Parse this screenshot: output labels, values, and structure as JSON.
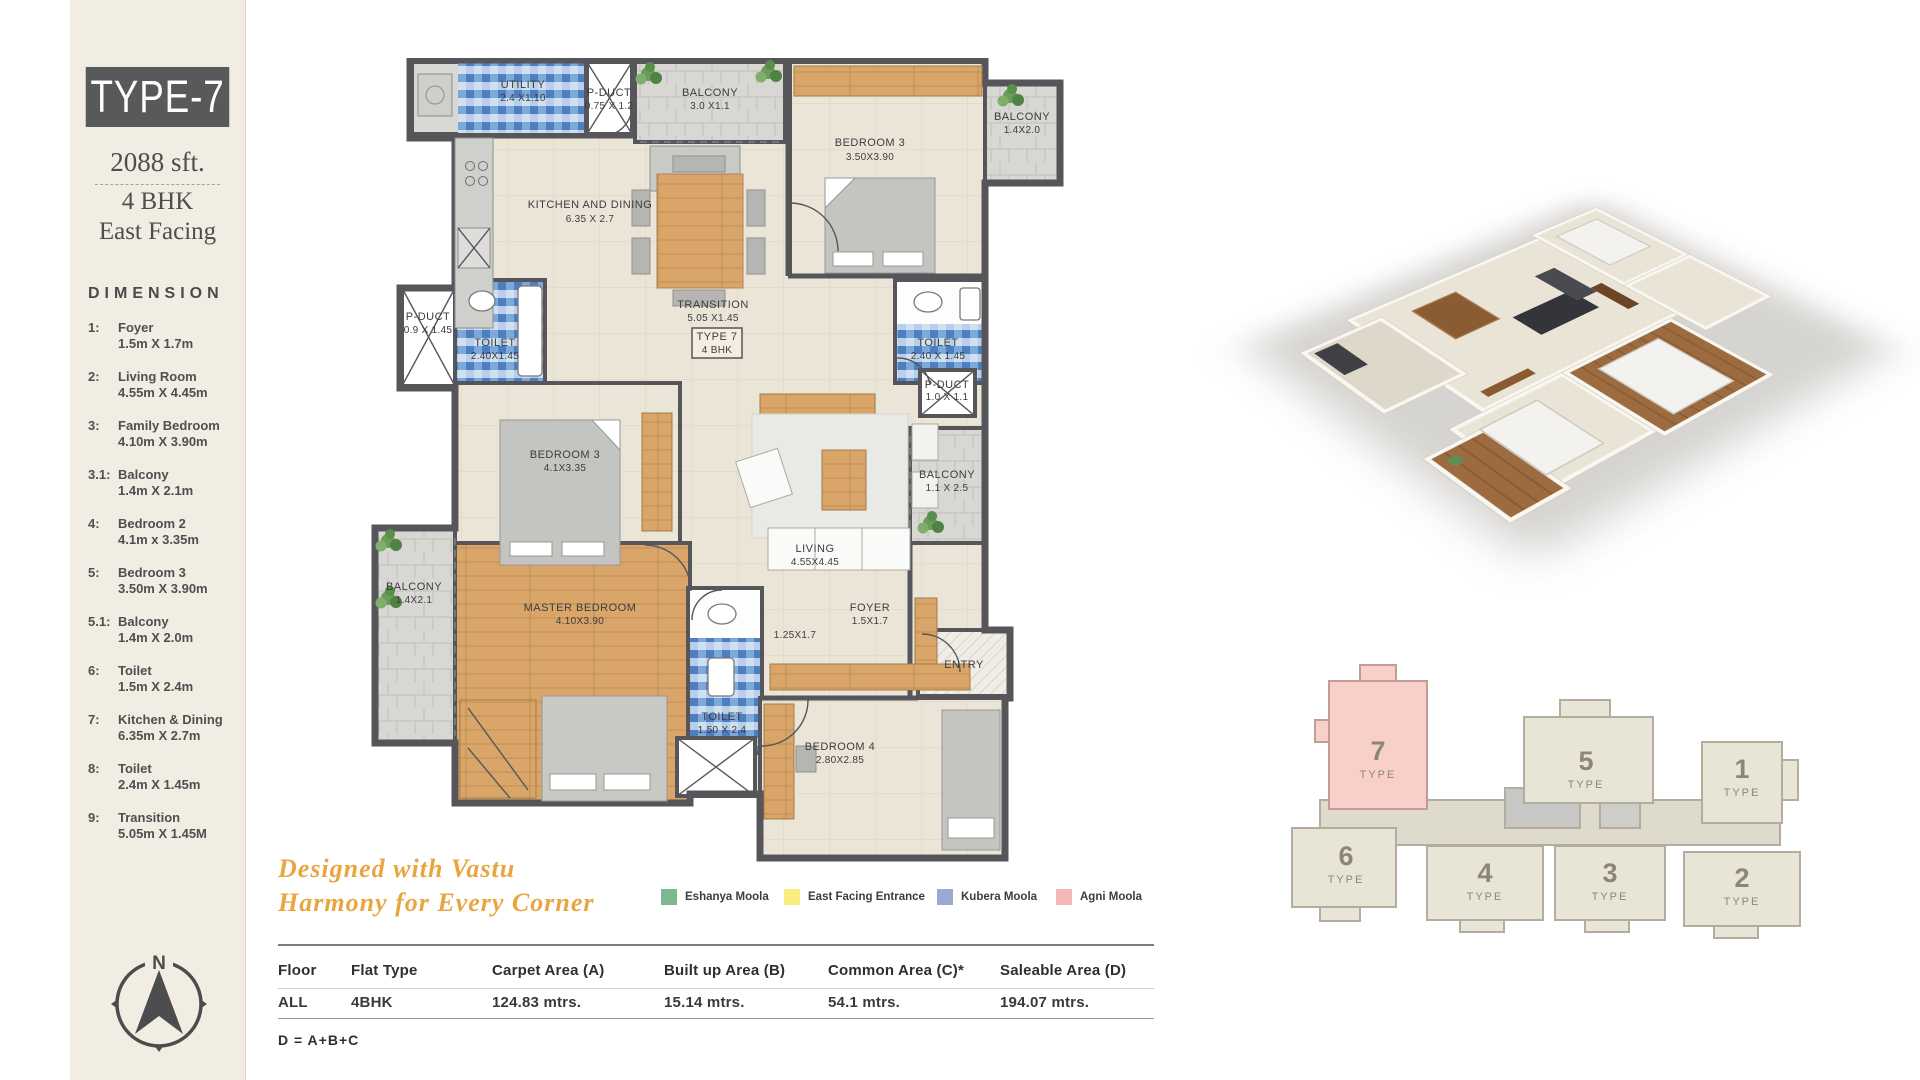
{
  "sidebar": {
    "type_label": "TYPE-7",
    "area": "2088 sft.",
    "bhk": "4 BHK",
    "facing": "East Facing",
    "dimension_title": "DIMENSION",
    "compass_north": "N",
    "dimensions": [
      {
        "no": "1:",
        "label": "Foyer",
        "size": "1.5m X 1.7m"
      },
      {
        "no": "2:",
        "label": "Living Room",
        "size": "4.55m X 4.45m"
      },
      {
        "no": "3:",
        "label": "Family Bedroom",
        "size": "4.10m X 3.90m"
      },
      {
        "no": "3.1:",
        "label": "Balcony",
        "size": "1.4m X 2.1m"
      },
      {
        "no": "4:",
        "label": "Bedroom 2",
        "size": "4.1m x 3.35m"
      },
      {
        "no": "5:",
        "label": "Bedroom 3",
        "size": "3.50m X 3.90m"
      },
      {
        "no": "5.1:",
        "label": "Balcony",
        "size": "1.4m X 2.0m"
      },
      {
        "no": "6:",
        "label": "Toilet",
        "size": "1.5m X 2.4m"
      },
      {
        "no": "7:",
        "label": "Kitchen & Dining",
        "size": "6.35m X 2.7m"
      },
      {
        "no": "8:",
        "label": "Toilet",
        "size": "2.4m X 1.45m"
      },
      {
        "no": "9:",
        "label": "Transition",
        "size": "5.05m X 1.45M"
      }
    ]
  },
  "floor_plan": {
    "rooms": [
      {
        "name": "UTILITY",
        "dim": "2.4 X1.10"
      },
      {
        "name": "P-DUCT",
        "dim": "0.75 X 1.2"
      },
      {
        "name": "BALCONY",
        "dim": "3.0 X1.1"
      },
      {
        "name": "BEDROOM 3",
        "dim": "3.50X3.90"
      },
      {
        "name": "BALCONY",
        "dim": "1.4X2.0"
      },
      {
        "name": "KITCHEN AND DINING",
        "dim": "6.35 X 2.7"
      },
      {
        "name": "P-DUCT",
        "dim": "0.9 X 1.45"
      },
      {
        "name": "TOILET",
        "dim": "2.40X1.45"
      },
      {
        "name": "TOILET",
        "dim": "2.40 X 1.45"
      },
      {
        "name": "TRANSITION",
        "dim": "5.05 X1.45"
      },
      {
        "name": "P-DUCT",
        "dim": "1.0 X 1.1"
      },
      {
        "name": "BEDROOM 3",
        "dim": "4.1X3.35"
      },
      {
        "name": "BALCONY",
        "dim": "1.1 X 2.5"
      },
      {
        "name": "LIVING",
        "dim": "4.55X4.45"
      },
      {
        "name": "BALCONY",
        "dim": "1.4X2.1"
      },
      {
        "name": "MASTER BEDROOM",
        "dim": "4.10X3.90"
      },
      {
        "name": "TOILET",
        "dim": "1.50 X 2.4"
      },
      {
        "name": "FOYER",
        "dim": "1.5X1.7"
      },
      {
        "name": "BEDROOM 4",
        "dim": "2.80X2.85"
      }
    ],
    "type_box": {
      "line1": "TYPE 7",
      "line2": "4 BHK"
    },
    "entry_label": "ENTRY",
    "corridor_dim": "1.25X1.7"
  },
  "vastu": {
    "heading_line1": "Designed with Vastu",
    "heading_line2": "Harmony for Every Corner",
    "legend": [
      {
        "label": "Eshanya Moola",
        "color": "#7fb793"
      },
      {
        "label": "East Facing Entrance",
        "color": "#f8ee7d"
      },
      {
        "label": "Kubera Moola",
        "color": "#9aa9d2"
      },
      {
        "label": "Agni Moola",
        "color": "#f5b9b5"
      }
    ]
  },
  "area_table": {
    "headers": [
      "Floor",
      "Flat Type",
      "Carpet Area (A)",
      "Built up Area (B)",
      "Common Area (C)*",
      "Saleable Area (D)"
    ],
    "rows": [
      [
        "ALL",
        "4BHK",
        "124.83 mtrs.",
        "15.14 mtrs.",
        "54.1 mtrs.",
        "194.07 mtrs."
      ]
    ],
    "footnote": "D = A+B+C"
  },
  "key_plan": {
    "highlight_color": "#f8cfc9",
    "units": [
      {
        "number": "7",
        "label": "TYPE",
        "highlighted": true
      },
      {
        "number": "5",
        "label": "TYPE",
        "highlighted": false
      },
      {
        "number": "1",
        "label": "TYPE",
        "highlighted": false
      },
      {
        "number": "6",
        "label": "TYPE",
        "highlighted": false
      },
      {
        "number": "4",
        "label": "TYPE",
        "highlighted": false
      },
      {
        "number": "3",
        "label": "TYPE",
        "highlighted": false
      },
      {
        "number": "2",
        "label": "TYPE",
        "highlighted": false
      }
    ]
  }
}
